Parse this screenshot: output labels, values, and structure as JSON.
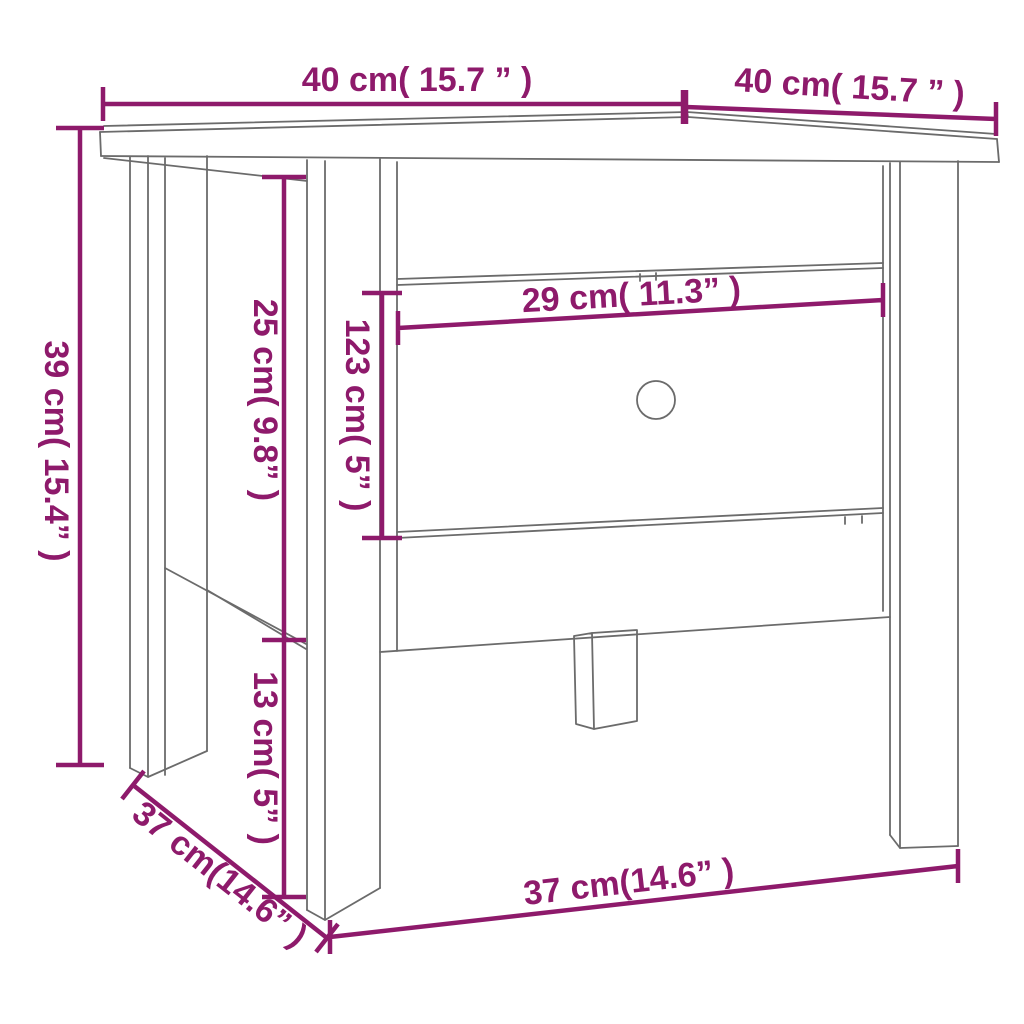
{
  "canvas": {
    "width": 1024,
    "height": 1024,
    "background": "#ffffff"
  },
  "colors": {
    "dimension": "#8e1a6b",
    "outline": "#6b6b6b"
  },
  "diagram": {
    "type": "furniture-dimension-drawing",
    "subject": "side table with drawer and round finger hole",
    "units": [
      "cm",
      "inches"
    ]
  },
  "dims": {
    "top_width": {
      "label": "40 cm( 15.7 ” )",
      "cm": "40",
      "inches": "15.7",
      "orientation": "horizontal",
      "position": "top-left"
    },
    "top_depth": {
      "label": "40 cm( 15.7 ” )",
      "cm": "40",
      "inches": "15.7",
      "orientation": "horizontal-sloped",
      "position": "top-right"
    },
    "height": {
      "label": "39 cm( 15.4” )",
      "cm": "39",
      "inches": "15.4",
      "orientation": "vertical",
      "position": "left"
    },
    "upper_side": {
      "label": "25 cm( 9.8” )",
      "cm": "25",
      "inches": "9.8",
      "orientation": "vertical",
      "position": "left-inner"
    },
    "drawer_height": {
      "label": "123 cm( 5” )",
      "cm": "123",
      "inches": "5",
      "orientation": "vertical",
      "position": "drawer-left"
    },
    "drawer_width": {
      "label": "29 cm( 11.3” )",
      "cm": "29",
      "inches": "11.3",
      "orientation": "horizontal-sloped",
      "position": "drawer-top"
    },
    "leg_clearance": {
      "label": "13 cm( 5” )",
      "cm": "13",
      "inches": "5",
      "orientation": "vertical",
      "position": "left-inner-lower"
    },
    "base_depth": {
      "label": "37 cm(14.6” )",
      "cm": "37",
      "inches": "14.6",
      "orientation": "diagonal",
      "position": "bottom-left"
    },
    "base_width": {
      "label": "37 cm(14.6” )",
      "cm": "37",
      "inches": "14.6",
      "orientation": "horizontal-sloped",
      "position": "bottom"
    }
  }
}
